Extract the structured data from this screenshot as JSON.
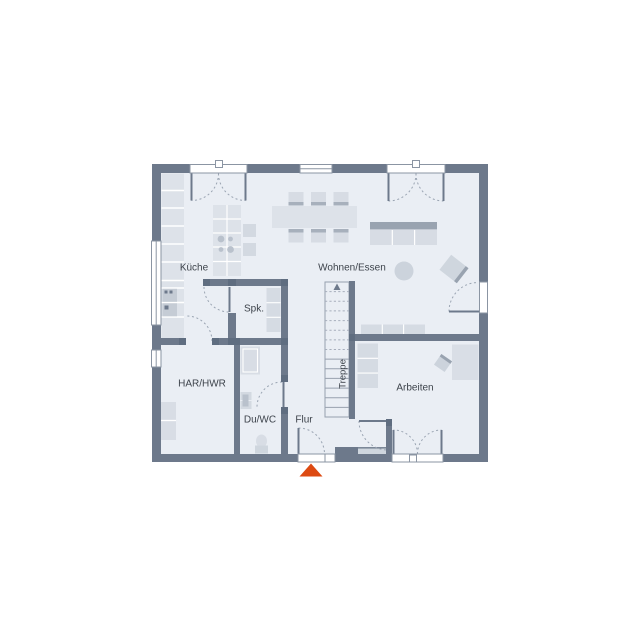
{
  "title": "floor-plan-ground-floor",
  "colors": {
    "background": "#ffffff",
    "floor": "#eaeef4",
    "wall": "#6d798b",
    "wall_junction": "#5f6d80",
    "furniture_light": "#d7dce4",
    "furniture_mid": "#ccd3dc",
    "furniture_dark": "#99a3b0",
    "appliance": "#c5ccd5",
    "window_frame": "#8b95a3",
    "swing_arc": "#9aa4b2",
    "stair_line": "#97a0ae",
    "label_text": "#3d434b",
    "entrance_marker": "#dd4a12"
  },
  "rooms": [
    {
      "id": "kueche",
      "label": "Küche"
    },
    {
      "id": "wohnen-essen",
      "label": "Wohnen/Essen"
    },
    {
      "id": "spk",
      "label": "Spk."
    },
    {
      "id": "har-hwr",
      "label": "HAR/HWR"
    },
    {
      "id": "du-wc",
      "label": "Du/WC"
    },
    {
      "id": "flur",
      "label": "Flur"
    },
    {
      "id": "treppe",
      "label": "Treppe"
    },
    {
      "id": "arbeiten",
      "label": "Arbeiten"
    }
  ],
  "markers": {
    "entrance": "entrance-triangle"
  }
}
